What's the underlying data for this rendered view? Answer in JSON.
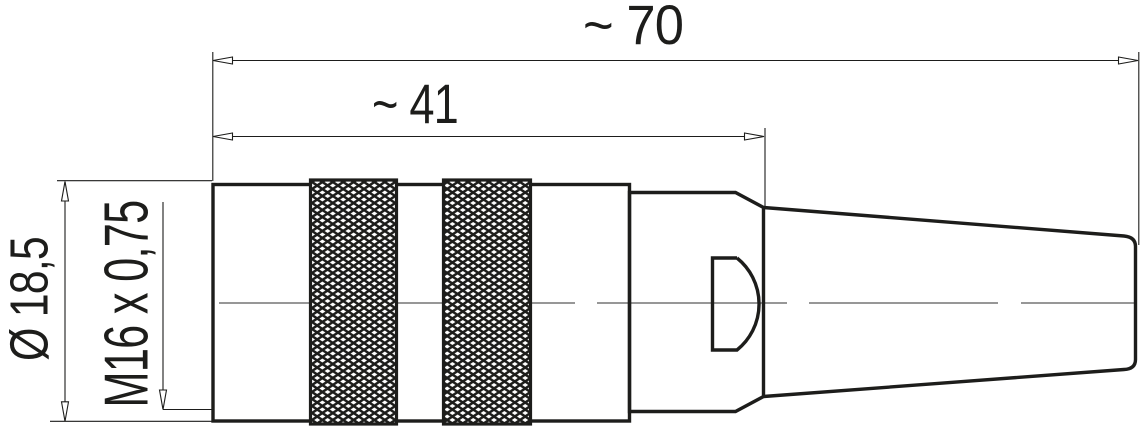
{
  "labels": {
    "overall_length": "~ 70",
    "body_length": "~ 41",
    "diameter": "Ø 18,5",
    "thread": "M16 x 0,75"
  },
  "colors": {
    "ink": "#1d1d1b",
    "centerline": "#595959",
    "background": "#ffffff"
  }
}
